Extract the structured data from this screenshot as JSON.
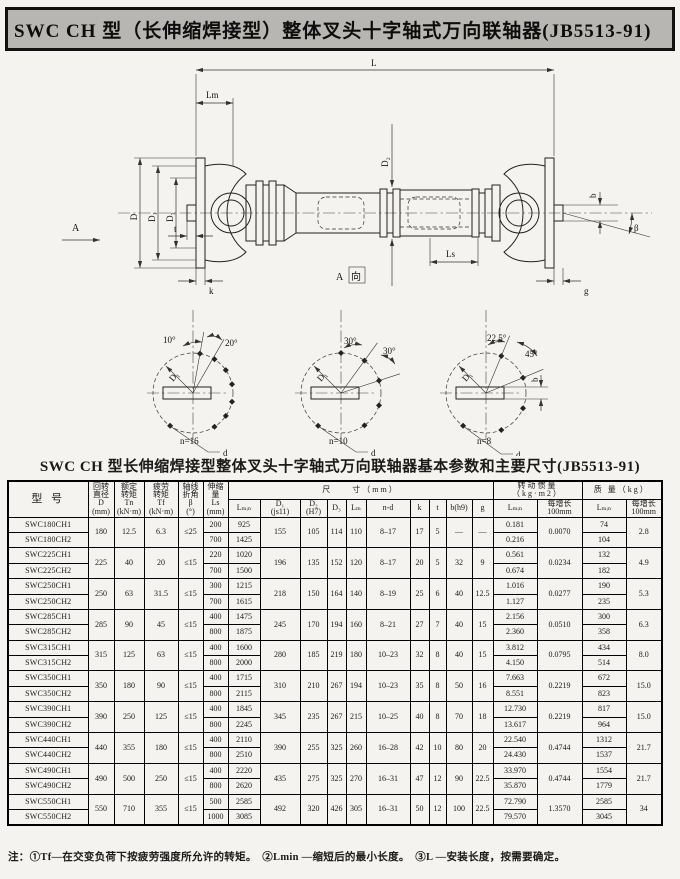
{
  "page_title": "SWC CH 型（长伸缩焊接型）整体叉头十字轴式万向联轴器(JB5513-91)",
  "drawing": {
    "labels": {
      "L": "L",
      "Lm": "Lm",
      "D": "D",
      "D1": "D₁",
      "D3": "D₃",
      "D2": "D₂",
      "Ls": "Ls",
      "k": "k",
      "t": "t",
      "b": "b",
      "g": "g",
      "beta": "β",
      "A": "A",
      "A_view_a": "A",
      "A_view_xiang": "向"
    },
    "details": [
      {
        "angles": [
          "10°",
          "20°"
        ],
        "bcd": "D₁",
        "hole": "d",
        "n": "n=16"
      },
      {
        "angles": [
          "30°",
          "30°"
        ],
        "bcd": "D₁",
        "hole": "d",
        "n": "n=10"
      },
      {
        "angles": [
          "22.5°",
          "45°"
        ],
        "bcd": "D₁",
        "hole": "d",
        "n": "n=8",
        "extra": "b"
      }
    ]
  },
  "table": {
    "title": "SWC CH 型长伸缩焊接型整体叉头十字轴式万向联轴器基本参数和主要尺寸(JB5513-91)",
    "headers": {
      "model": "型  号",
      "d": "回转\n直径\nD\n(mm)",
      "tn": "额定\n转矩\nTn\n(kN·m)",
      "tf": "疲劳\n转矩\nTf\n(kN·m)",
      "beta": "轴线\n折角\nβ\n(°)",
      "ls": "伸缩\n量\nLs\n(mm)",
      "size_group": "尺　　寸（mm）",
      "lmin": "Lₘᵢₙ",
      "d1": "D₁\n(js11)",
      "d2": "D₂\n(H7)",
      "d3": "D₃",
      "lm": "Lₘ",
      "nd": "n-d",
      "k": "k",
      "t": "t",
      "b": "b(h9)",
      "g": "g",
      "inertia_group": "转动惯量（kg·m2）",
      "inertia_lmin": "Lₘᵢₙ",
      "inertia_per": "每增长\n100mm",
      "mass_group": "质 量（kg）",
      "mass_lmin": "Lₘᵢₙ",
      "mass_per": "每增长\n100mm"
    },
    "groups": [
      {
        "models": [
          "SWC180CH1",
          "SWC180CH2"
        ],
        "D": "180",
        "Tn": "12.5",
        "Tf": "6.3",
        "beta": "≤25",
        "Ls": [
          "200",
          "700"
        ],
        "Lmin": [
          "925",
          "1425"
        ],
        "D1": "155",
        "D2": "105",
        "D3": "114",
        "Lm": "110",
        "nd": "8–17",
        "k": "17",
        "t": "5",
        "b": "—",
        "g": "—",
        "J": [
          "0.181",
          "0.216"
        ],
        "Jper": "0.0070",
        "m": [
          "74",
          "104"
        ],
        "mper": "2.8"
      },
      {
        "models": [
          "SWC225CH1",
          "SWC225CH2"
        ],
        "D": "225",
        "Tn": "40",
        "Tf": "20",
        "beta": "≤15",
        "Ls": [
          "220",
          "700"
        ],
        "Lmin": [
          "1020",
          "1500"
        ],
        "D1": "196",
        "D2": "135",
        "D3": "152",
        "Lm": "120",
        "nd": "8–17",
        "k": "20",
        "t": "5",
        "b": "32",
        "g": "9",
        "J": [
          "0.561",
          "0.674"
        ],
        "Jper": "0.0234",
        "m": [
          "132",
          "182"
        ],
        "mper": "4.9"
      },
      {
        "models": [
          "SWC250CH1",
          "SWC250CH2"
        ],
        "D": "250",
        "Tn": "63",
        "Tf": "31.5",
        "beta": "≤15",
        "Ls": [
          "300",
          "700"
        ],
        "Lmin": [
          "1215",
          "1615"
        ],
        "D1": "218",
        "D2": "150",
        "D3": "164",
        "Lm": "140",
        "nd": "8–19",
        "k": "25",
        "t": "6",
        "b": "40",
        "g": "12.5",
        "J": [
          "1.016",
          "1.127"
        ],
        "Jper": "0.0277",
        "m": [
          "190",
          "235"
        ],
        "mper": "5.3"
      },
      {
        "models": [
          "SWC285CH1",
          "SWC285CH2"
        ],
        "D": "285",
        "Tn": "90",
        "Tf": "45",
        "beta": "≤15",
        "Ls": [
          "400",
          "800"
        ],
        "Lmin": [
          "1475",
          "1875"
        ],
        "D1": "245",
        "D2": "170",
        "D3": "194",
        "Lm": "160",
        "nd": "8–21",
        "k": "27",
        "t": "7",
        "b": "40",
        "g": "15",
        "J": [
          "2.156",
          "2.360"
        ],
        "Jper": "0.0510",
        "m": [
          "300",
          "358"
        ],
        "mper": "6.3"
      },
      {
        "models": [
          "SWC315CH1",
          "SWC315CH2"
        ],
        "D": "315",
        "Tn": "125",
        "Tf": "63",
        "beta": "≤15",
        "Ls": [
          "400",
          "800"
        ],
        "Lmin": [
          "1600",
          "2000"
        ],
        "D1": "280",
        "D2": "185",
        "D3": "219",
        "Lm": "180",
        "nd": "10–23",
        "k": "32",
        "t": "8",
        "b": "40",
        "g": "15",
        "J": [
          "3.812",
          "4.150"
        ],
        "Jper": "0.0795",
        "m": [
          "434",
          "514"
        ],
        "mper": "8.0"
      },
      {
        "models": [
          "SWC350CH1",
          "SWC350CH2"
        ],
        "D": "350",
        "Tn": "180",
        "Tf": "90",
        "beta": "≤15",
        "Ls": [
          "400",
          "800"
        ],
        "Lmin": [
          "1715",
          "2115"
        ],
        "D1": "310",
        "D2": "210",
        "D3": "267",
        "Lm": "194",
        "nd": "10–23",
        "k": "35",
        "t": "8",
        "b": "50",
        "g": "16",
        "J": [
          "7.663",
          "8.551"
        ],
        "Jper": "0.2219",
        "m": [
          "672",
          "823"
        ],
        "mper": "15.0"
      },
      {
        "models": [
          "SWC390CH1",
          "SWC390CH2"
        ],
        "D": "390",
        "Tn": "250",
        "Tf": "125",
        "beta": "≤15",
        "Ls": [
          "400",
          "800"
        ],
        "Lmin": [
          "1845",
          "2245"
        ],
        "D1": "345",
        "D2": "235",
        "D3": "267",
        "Lm": "215",
        "nd": "10–25",
        "k": "40",
        "t": "8",
        "b": "70",
        "g": "18",
        "J": [
          "12.730",
          "13.617"
        ],
        "Jper": "0.2219",
        "m": [
          "817",
          "964"
        ],
        "mper": "15.0"
      },
      {
        "models": [
          "SWC440CH1",
          "SWC440CH2"
        ],
        "D": "440",
        "Tn": "355",
        "Tf": "180",
        "beta": "≤15",
        "Ls": [
          "400",
          "800"
        ],
        "Lmin": [
          "2110",
          "2510"
        ],
        "D1": "390",
        "D2": "255",
        "D3": "325",
        "Lm": "260",
        "nd": "16–28",
        "k": "42",
        "t": "10",
        "b": "80",
        "g": "20",
        "J": [
          "22.540",
          "24.430"
        ],
        "Jper": "0.4744",
        "m": [
          "1312",
          "1537"
        ],
        "mper": "21.7"
      },
      {
        "models": [
          "SWC490CH1",
          "SWC490CH2"
        ],
        "D": "490",
        "Tn": "500",
        "Tf": "250",
        "beta": "≤15",
        "Ls": [
          "400",
          "800"
        ],
        "Lmin": [
          "2220",
          "2620"
        ],
        "D1": "435",
        "D2": "275",
        "D3": "325",
        "Lm": "270",
        "nd": "16–31",
        "k": "47",
        "t": "12",
        "b": "90",
        "g": "22.5",
        "J": [
          "33.970",
          "35.870"
        ],
        "Jper": "0.4744",
        "m": [
          "1554",
          "1779"
        ],
        "mper": "21.7"
      },
      {
        "models": [
          "SWC550CH1",
          "SWC550CH2"
        ],
        "D": "550",
        "Tn": "710",
        "Tf": "355",
        "beta": "≤15",
        "Ls": [
          "500",
          "1000"
        ],
        "Lmin": [
          "2585",
          "3085"
        ],
        "D1": "492",
        "D2": "320",
        "D3": "426",
        "Lm": "305",
        "nd": "16–31",
        "k": "50",
        "t": "12",
        "b": "100",
        "g": "22.5",
        "J": [
          "72.790",
          "79.570"
        ],
        "Jper": "1.3570",
        "m": [
          "2585",
          "3045"
        ],
        "mper": "34"
      }
    ]
  },
  "footnote": "注：①Tf—在交变负荷下按疲劳强度所允许的转矩。　②Lmin —缩短后的最小长度。　③L —安装长度，按需要确定。"
}
